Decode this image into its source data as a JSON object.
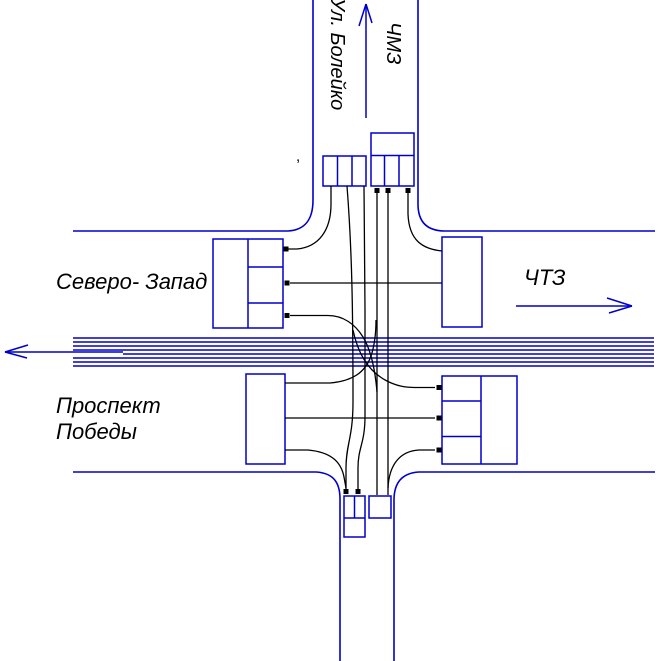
{
  "diagram": {
    "title_hint": "traffic flow scheme of intersection",
    "labels": {
      "street_top": "Ул. Болейко",
      "area_top_right": "ЧМЗ",
      "area_left": "Северо- Запад",
      "area_right": "ЧТЗ",
      "street_bottom_line1": "Проспект",
      "street_bottom_line2": "Победы",
      "stray_mark": ","
    },
    "colors": {
      "road": "#0000cc",
      "flow": "#000000",
      "text": "#000000",
      "background": "#ffffff"
    },
    "direction_arrows": [
      {
        "name": "north-arrow",
        "street": "Ул. Болейко / ЧМЗ",
        "direction": "up"
      },
      {
        "name": "west-arrow",
        "street": "Проспект Победы",
        "direction": "left"
      },
      {
        "name": "east-arrow",
        "street": "ЧТЗ",
        "direction": "right"
      }
    ],
    "lane_boxes": [
      {
        "name": "southbound-approach-box",
        "side": "top-left",
        "cells": 3
      },
      {
        "name": "northbound-exit-box",
        "side": "top-right",
        "cells": 4
      },
      {
        "name": "westbound-exit-box",
        "side": "west-upper",
        "cells": 4
      },
      {
        "name": "westbound-approach-box",
        "side": "east-upper",
        "cells": 1
      },
      {
        "name": "eastbound-approach-box",
        "side": "west-lower",
        "cells": 1
      },
      {
        "name": "eastbound-exit-box",
        "side": "east-lower",
        "cells": 4
      },
      {
        "name": "southbound-exit-box",
        "side": "bottom-left",
        "cells": 3
      },
      {
        "name": "northbound-approach-box",
        "side": "bottom-right",
        "cells": 1
      }
    ],
    "movements": [
      "southbound-right-turn",
      "southbound-through-1",
      "southbound-through-2",
      "southbound-left-turn",
      "northbound-through-1",
      "northbound-through-2",
      "northbound-left-turn",
      "northbound-right-turn",
      "eastbound-through",
      "eastbound-left-turn",
      "eastbound-right-turn",
      "westbound-through",
      "westbound-right-turn"
    ]
  }
}
